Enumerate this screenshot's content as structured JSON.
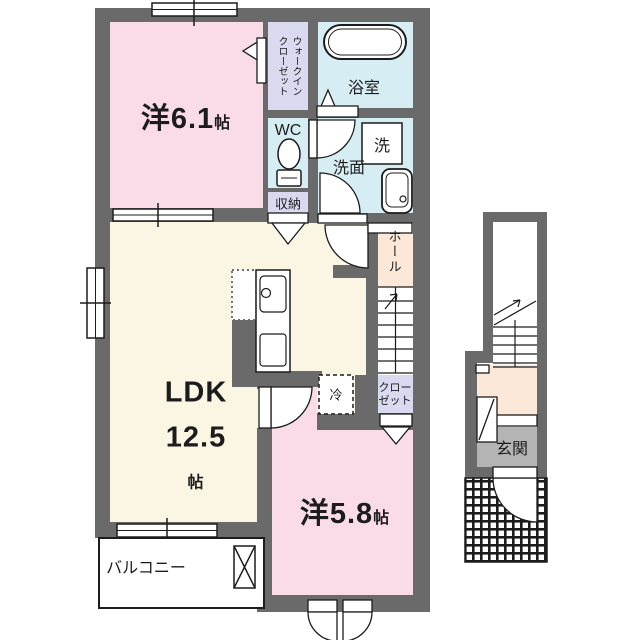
{
  "plan_title": "apartment floor plan",
  "labels": {
    "bedroom1": "洋6.1",
    "bedroom1_unit": "帖",
    "wic_col1": "ウォークイン",
    "wic_col2": "クローゼット",
    "wc": "WC",
    "storage": "収納",
    "bath": "浴室",
    "washer": "洗",
    "washroom": "洗面",
    "hall": "ホール",
    "ldk_name": "LDK",
    "ldk_size": "12.5",
    "ldk_unit": "帖",
    "fridge": "冷",
    "closet_line1": "クロー",
    "closet_line2": "ゼット",
    "bedroom2": "洋5.8",
    "bedroom2_unit": "帖",
    "balcony": "バルコニー",
    "entrance": "玄関"
  },
  "colors": {
    "wall": "#6a6a6a",
    "bedroom_pink": "#f9dce8",
    "ldk_cream": "#faf6e3",
    "wet_cyan": "#d7edf4",
    "closet_lavender": "#d9d9f0",
    "hall_peach": "#fbe8d8",
    "entrance_gray": "#b4b4b4",
    "line": "#1c1c1c"
  }
}
